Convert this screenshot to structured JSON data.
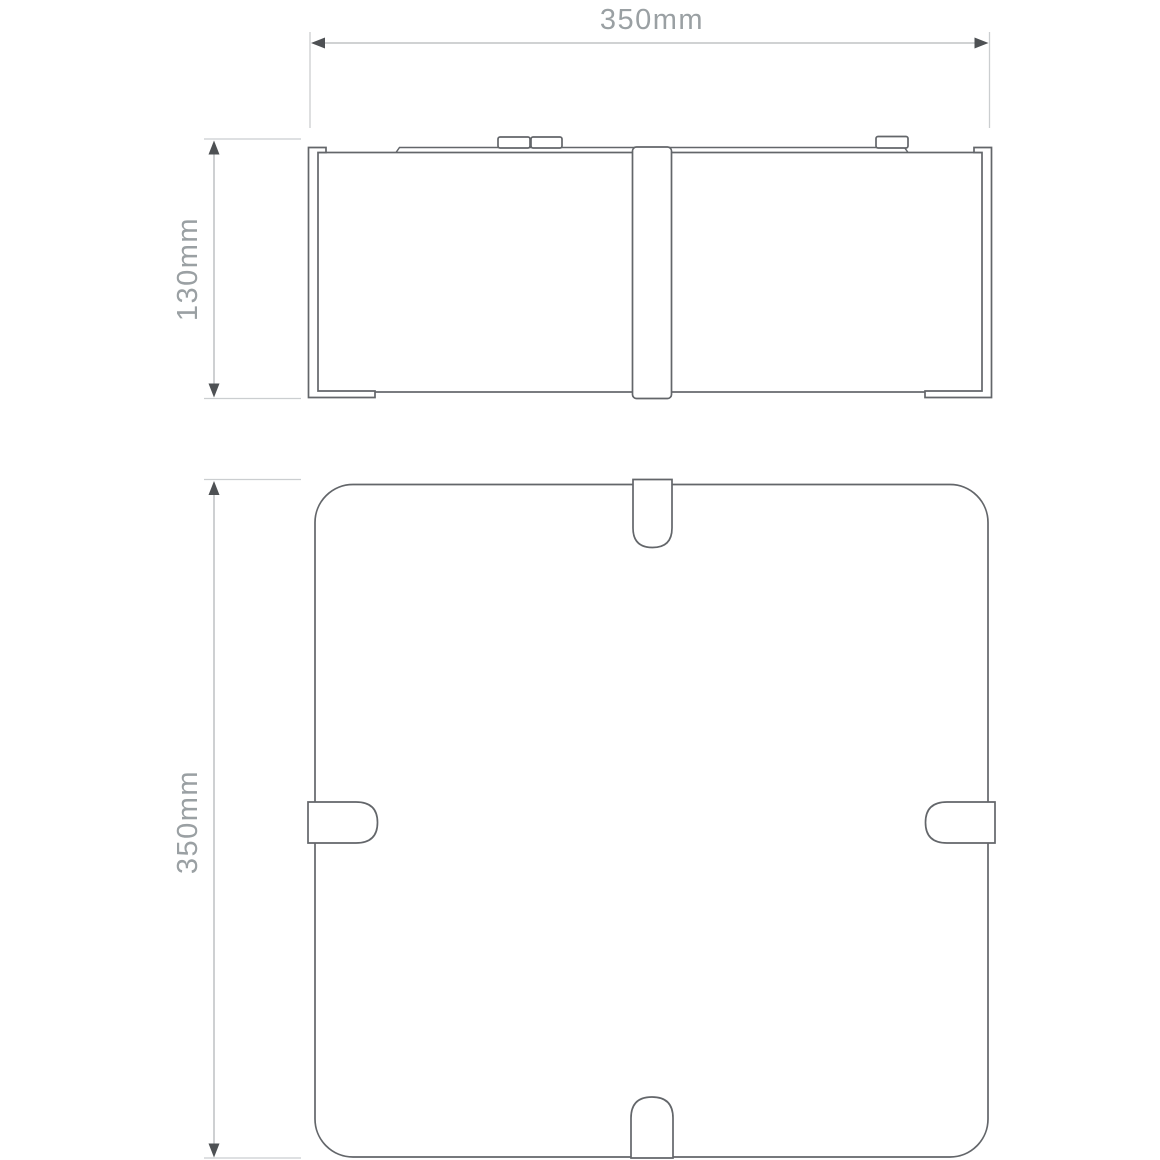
{
  "document": {
    "type": "technical-dimension-drawing",
    "views": {
      "side": "side elevation view",
      "plan": "plan view"
    }
  },
  "dimensions": {
    "side_width": {
      "label": "350mm",
      "orientation": "horizontal"
    },
    "side_height": {
      "label": "130mm",
      "orientation": "vertical"
    },
    "plan_height": {
      "label": "350mm",
      "orientation": "vertical"
    }
  },
  "colors": {
    "outline": "#63666a",
    "dimension-line": "#b4b7b9",
    "extension-line": "#cbced0",
    "arrowhead": "#4e5154",
    "label-text": "#9aa0a3",
    "background": "#ffffff"
  }
}
